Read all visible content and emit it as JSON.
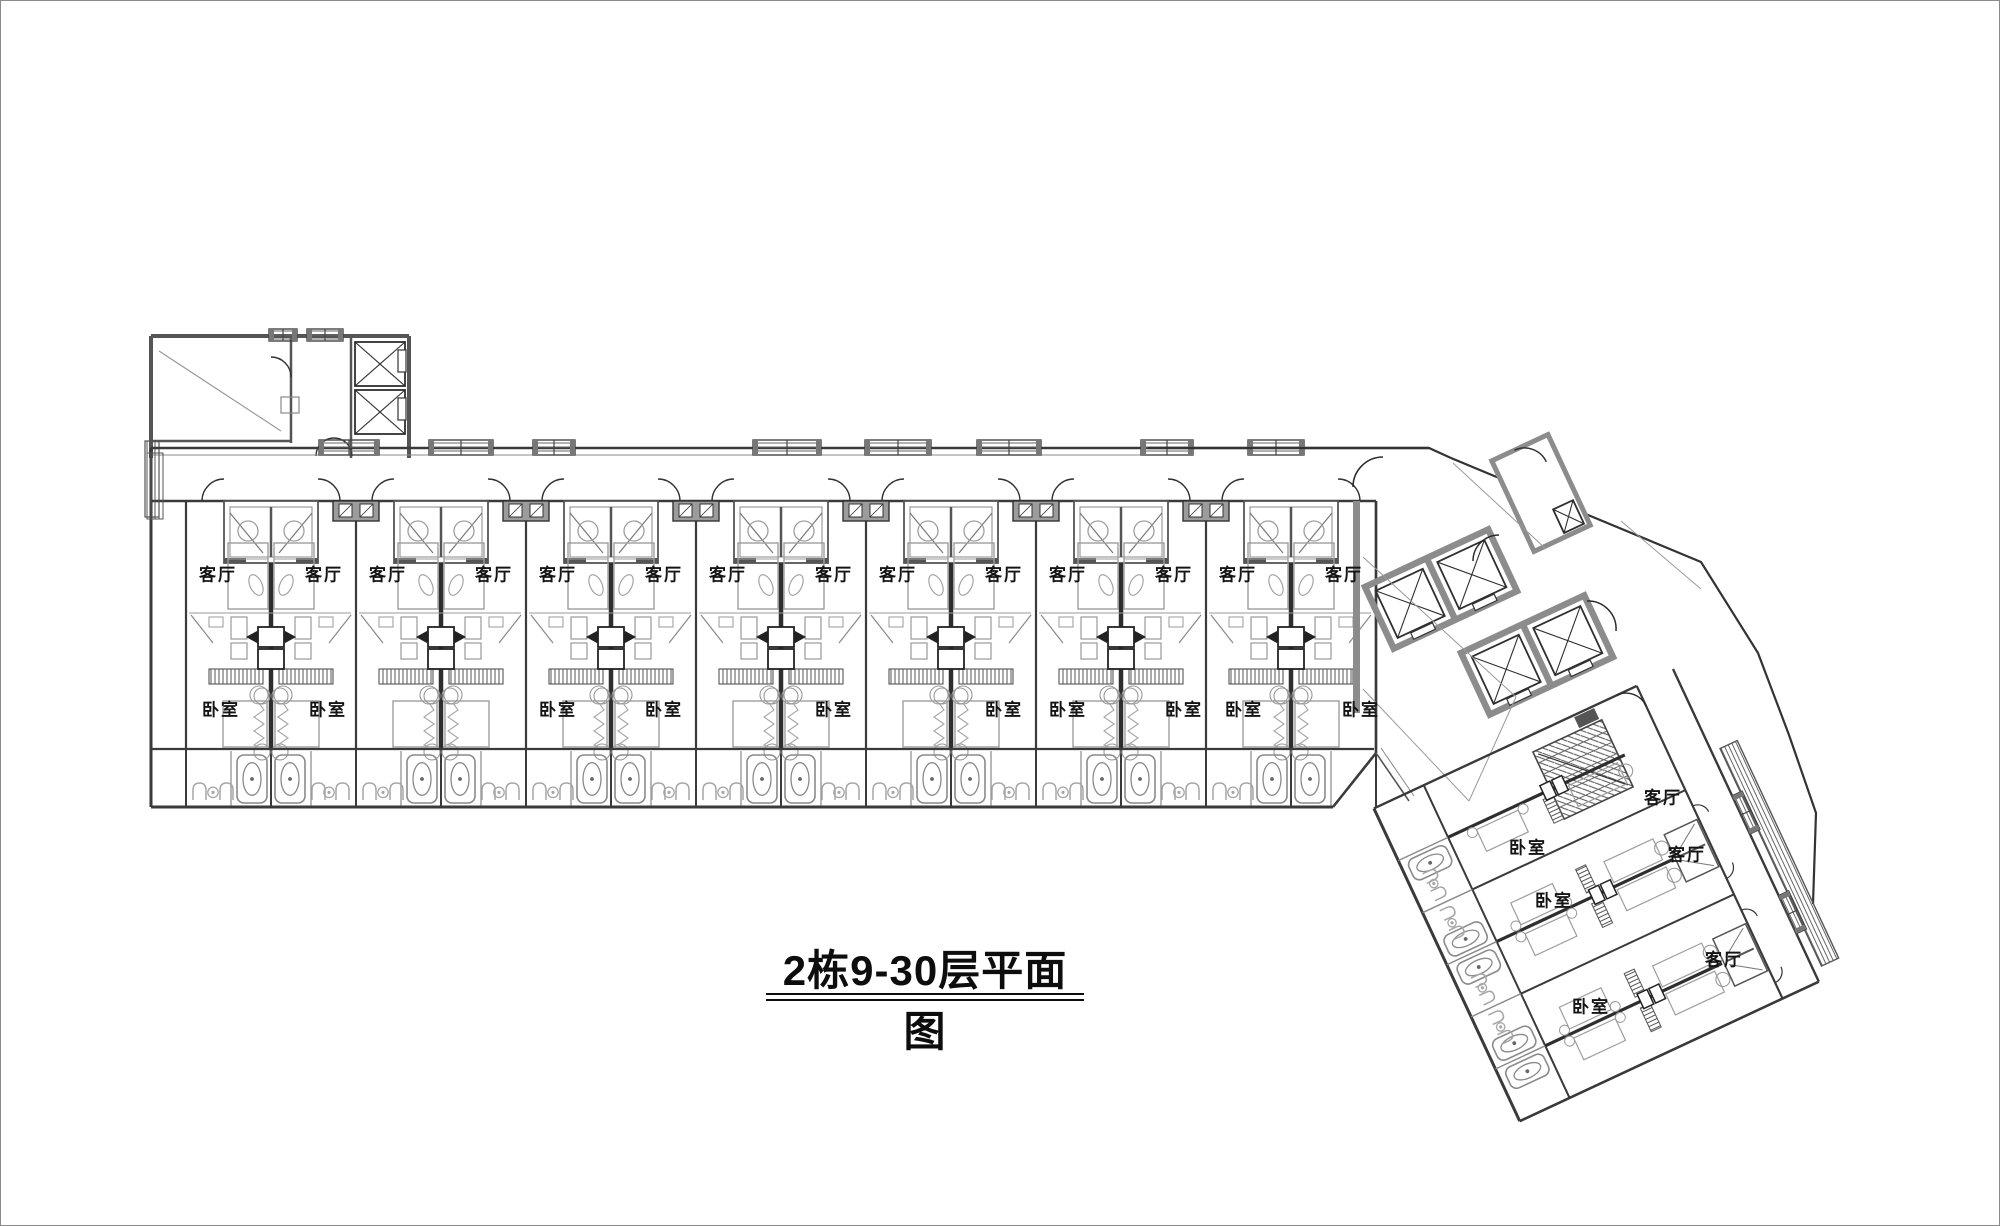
{
  "title": {
    "text": "2栋9-30层平面图"
  },
  "labels": {
    "living_room": "客厅",
    "bedroom": "卧室"
  },
  "colors": {
    "wall": "#3a3a3a",
    "wall_poche": "#8c8c8c",
    "fixture": "#a6a6a6",
    "bed": "#9e9e9e",
    "dark": "#222222",
    "text": "#141414",
    "background": "#ffffff"
  },
  "structure": {
    "horizontal_wing": {
      "unit_pairs": 7,
      "window_boxes": 8,
      "west_elevators": 2
    },
    "angled_wing": {
      "unit_pairs": 3,
      "rotation_deg": 65,
      "staircases": 1
    },
    "core_elevator_pairs": 2,
    "small_core_shafts": 1
  },
  "rooms": {
    "living_room_labels": [
      {
        "x": 217,
        "y": 572
      },
      {
        "x": 323,
        "y": 572
      },
      {
        "x": 387,
        "y": 572
      },
      {
        "x": 493,
        "y": 572
      },
      {
        "x": 557,
        "y": 572
      },
      {
        "x": 663,
        "y": 572
      },
      {
        "x": 727,
        "y": 572
      },
      {
        "x": 833,
        "y": 572
      },
      {
        "x": 897,
        "y": 572
      },
      {
        "x": 1003,
        "y": 572
      },
      {
        "x": 1067,
        "y": 572
      },
      {
        "x": 1173,
        "y": 572
      },
      {
        "x": 1237,
        "y": 572
      },
      {
        "x": 1343,
        "y": 572
      },
      {
        "x": 1662,
        "y": 795
      },
      {
        "x": 1686,
        "y": 852
      },
      {
        "x": 1723,
        "y": 957
      }
    ],
    "bedroom_labels": [
      {
        "x": 220,
        "y": 707
      },
      {
        "x": 327,
        "y": 707
      },
      {
        "x": 557,
        "y": 707
      },
      {
        "x": 663,
        "y": 707
      },
      {
        "x": 833,
        "y": 707
      },
      {
        "x": 1003,
        "y": 707
      },
      {
        "x": 1067,
        "y": 707
      },
      {
        "x": 1183,
        "y": 707
      },
      {
        "x": 1243,
        "y": 707
      },
      {
        "x": 1360,
        "y": 707
      },
      {
        "x": 1527,
        "y": 845
      },
      {
        "x": 1553,
        "y": 898
      },
      {
        "x": 1590,
        "y": 1004
      }
    ]
  }
}
